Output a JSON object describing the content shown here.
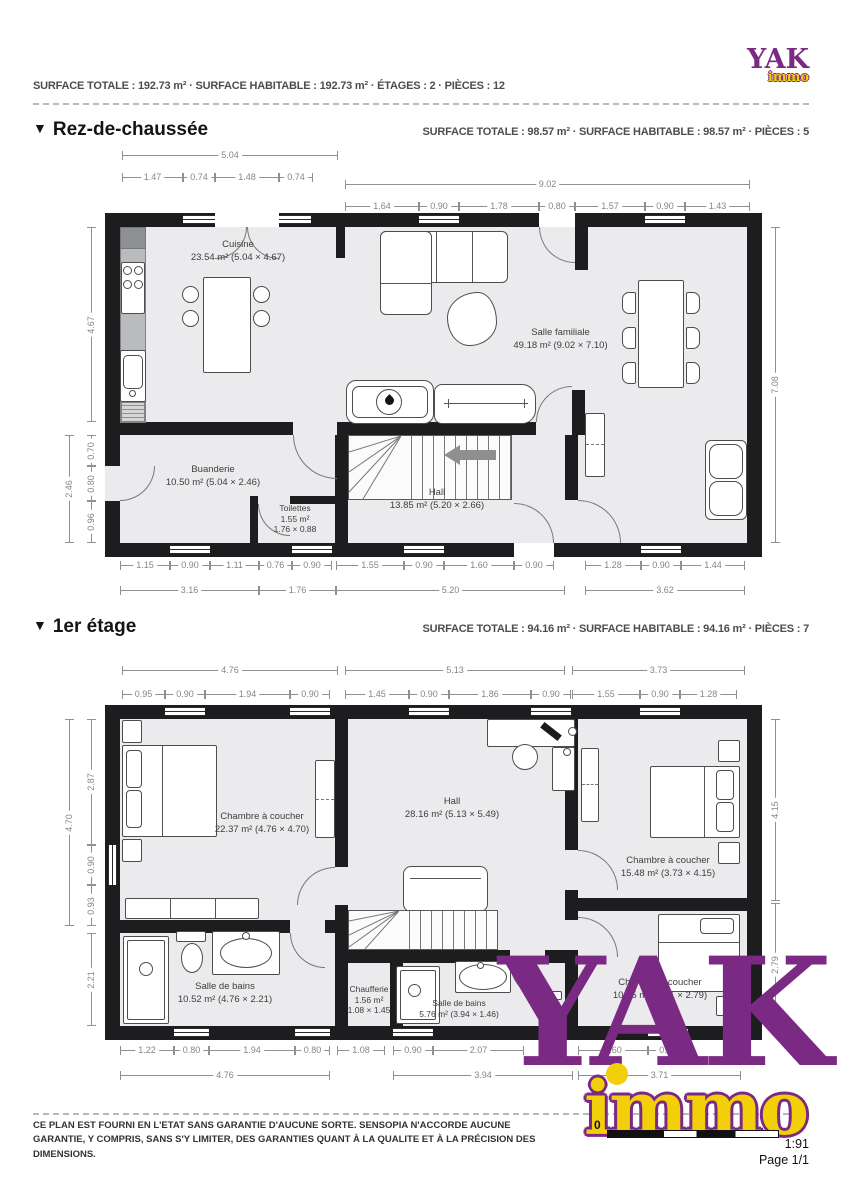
{
  "header": {
    "summary": "SURFACE TOTALE : 192.73 m² · SURFACE HABITABLE : 192.73 m² · ÉTAGES : 2 · PIÈCES : 12",
    "logo": {
      "yak": "YAK",
      "immo": "immo"
    }
  },
  "floor1": {
    "marker": "▼",
    "title": "Rez-de-chaussée",
    "summary": "SURFACE TOTALE : 98.57 m² · SURFACE HABITABLE : 98.57 m² · PIÈCES : 5",
    "rooms": {
      "cuisine": {
        "name": "Cuisine",
        "area": "23.54 m² (5.04 × 4.67)"
      },
      "salle_familiale": {
        "name": "Salle familiale",
        "area": "49.18 m² (9.02 × 7.10)"
      },
      "buanderie": {
        "name": "Buanderie",
        "area": "10.50 m² (5.04 × 2.46)"
      },
      "toilettes": {
        "name": "Toilettes",
        "area": "1.55 m²",
        "dims": "1.76 × 0.88"
      },
      "hall": {
        "name": "Hall",
        "area": "13.85 m² (5.20 × 2.66)"
      }
    },
    "dims": {
      "top_main": [
        "5.04",
        "9.02"
      ],
      "top_sub": [
        "1.47",
        "0.74",
        "1.48",
        "0.74",
        "1.64",
        "0.90",
        "1.78",
        "0.80",
        "1.57",
        "0.90",
        "1.43"
      ],
      "left": [
        "4.67",
        "2.46",
        "0.70",
        "0.80",
        "0.96"
      ],
      "right": [
        "7.08"
      ],
      "bottom_sub": [
        "1.15",
        "0.90",
        "1.11",
        "0.76",
        "0.90",
        "1.55",
        "0.90",
        "1.60",
        "0.90",
        "1.28",
        "0.90",
        "1.44"
      ],
      "bottom_main": [
        "3.16",
        "1.76",
        "5.20",
        "3.62"
      ]
    }
  },
  "floor2": {
    "marker": "▼",
    "title": "1er étage",
    "summary": "SURFACE TOTALE : 94.16 m² · SURFACE HABITABLE : 94.16 m² · PIÈCES : 7",
    "rooms": {
      "chambre1": {
        "name": "Chambre à coucher",
        "area": "22.37 m² (4.76 × 4.70)"
      },
      "hall": {
        "name": "Hall",
        "area": "28.16 m² (5.13 × 5.49)"
      },
      "chambre2": {
        "name": "Chambre à coucher",
        "area": "15.48 m² (3.73 × 4.15)"
      },
      "salle_de_bains1": {
        "name": "Salle de bains",
        "area": "10.52 m² (4.76 × 2.21)"
      },
      "chaufferie": {
        "name": "Chaufferie",
        "area": "1.56 m²",
        "dims": "1.08 × 1.45"
      },
      "salle_de_bains2": {
        "name": "Salle de bains",
        "area": "5.76 m² (3.94 × 1.46)"
      },
      "chambre3": {
        "name": "Chambre à coucher",
        "area": "10.35 m² (3.71 × 2.79)"
      }
    },
    "dims": {
      "top_main": [
        "4.76",
        "5.13",
        "3.73"
      ],
      "top_sub": [
        "0.95",
        "0.90",
        "1.94",
        "0.90",
        "1.45",
        "0.90",
        "1.86",
        "0.90",
        "1.55",
        "0.90",
        "1.28"
      ],
      "left": [
        "4.70",
        "2.87",
        "0.90",
        "0.93",
        "2.21"
      ],
      "right": [
        "4.15",
        "2.79"
      ],
      "bottom_sub": [
        "1.22",
        "0.80",
        "1.94",
        "0.80",
        "1.08",
        "0.90",
        "2.07",
        "1.60",
        "0.90"
      ],
      "bottom_main": [
        "4.76",
        "3.94",
        "3.71"
      ]
    }
  },
  "watermark": {
    "yak": "YAK",
    "immo": "immo"
  },
  "footer": {
    "disclaimer": "CE PLAN EST FOURNI EN L'ETAT SANS GARANTIE D'AUCUNE SORTE. SENSOPIA N'ACCORDE AUCUNE GARANTIE, Y COMPRIS, SANS S'Y LIMITER, DES GARANTIES QUANT À LA QUALITE ET À LA PRÉCISION DES DIMENSIONS.",
    "scale_zero": "0",
    "scale_ratio": "1:91",
    "page": "Page 1/1"
  },
  "colors": {
    "brand_purple": "#7b2a83",
    "brand_yellow": "#f3cf0a",
    "wall": "#1d1d1f",
    "room_fill": "#ebebed"
  }
}
